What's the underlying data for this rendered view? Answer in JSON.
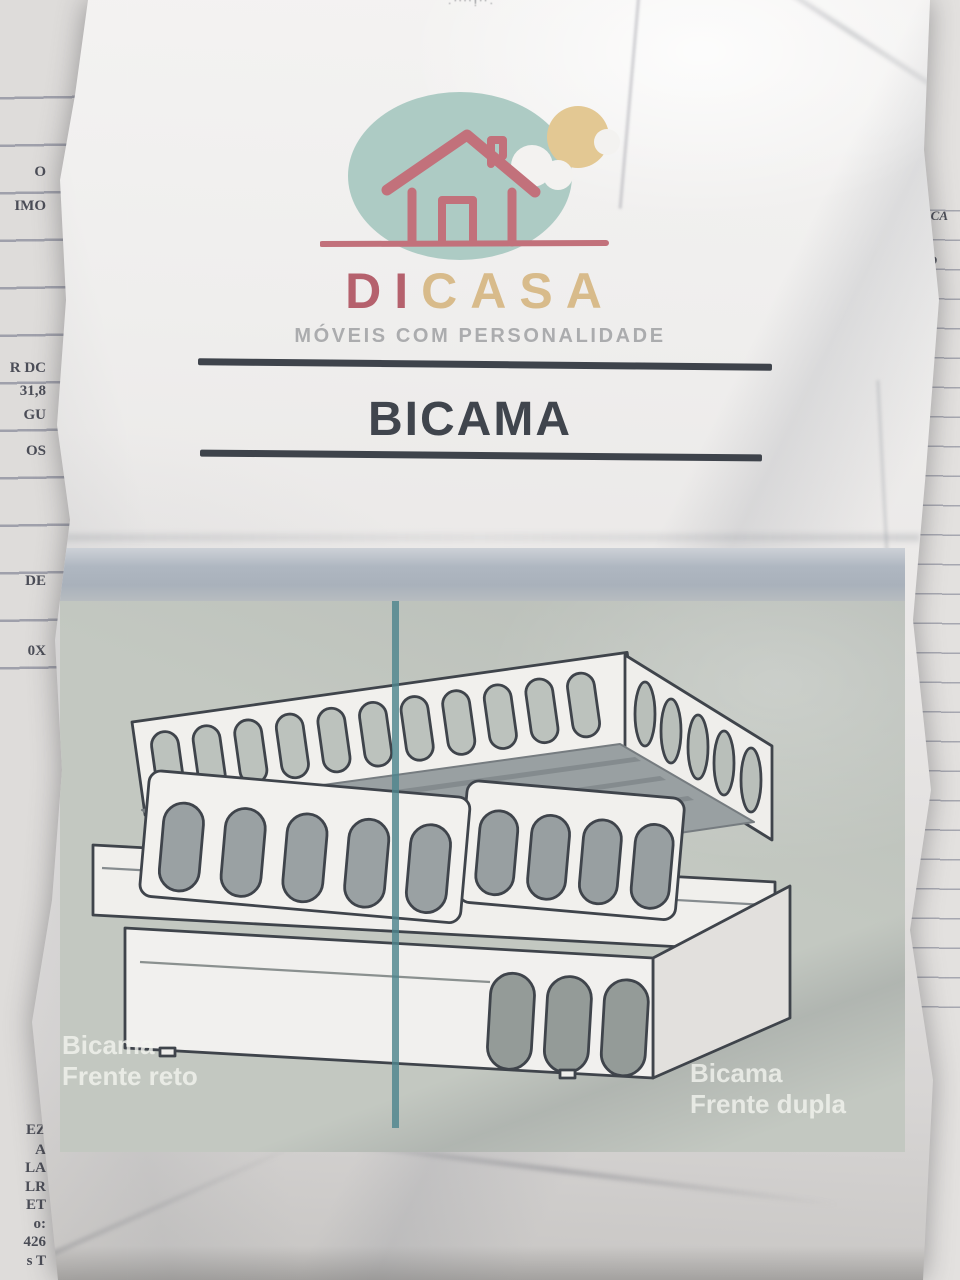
{
  "surroundings": {
    "top_edge_fragment": "·''''!''·",
    "left_page_fragments": [
      {
        "text": "O",
        "top": 164
      },
      {
        "text": "IMO",
        "top": 198
      },
      {
        "text": "R DC",
        "top": 360
      },
      {
        "text": "31,8",
        "top": 383
      },
      {
        "text": "GU",
        "top": 407
      },
      {
        "text": "OS",
        "top": 443
      },
      {
        "text": "DE",
        "top": 573
      },
      {
        "text": "0X",
        "top": 643
      },
      {
        "text": "EZ",
        "top": 1122
      },
      {
        "text": "A",
        "top": 1142
      },
      {
        "text": "LA",
        "top": 1160
      },
      {
        "text": "LR",
        "top": 1179
      },
      {
        "text": "ET",
        "top": 1197
      },
      {
        "text": "o:",
        "top": 1216
      },
      {
        "text": "426",
        "top": 1234
      },
      {
        "text": "s T",
        "top": 1253
      }
    ],
    "right_page_fragments": [
      {
        "text": "≡ CA",
        "top": 208
      },
      {
        "text": "0",
        "top": 232
      },
      {
        "text": "TO",
        "top": 253
      },
      {
        "text": "0,0",
        "top": 278
      }
    ]
  },
  "logo": {
    "brand_di": "DI",
    "brand_casa": "CASA",
    "tagline": "MÓVEIS COM PERSONALIDADE",
    "colors": {
      "circle": "#adcbc4",
      "sun": "#e3c893",
      "cloud": "#f3f2f0",
      "house_outline": "#c2717b",
      "di_text": "#b5616d",
      "casa_text": "#d8bb8b",
      "tagline_text": "#95979a"
    }
  },
  "title": {
    "text": "BICAMA",
    "color": "#40454d"
  },
  "illustration": {
    "divider_color": "#4e858d",
    "label_left_line1": "Bicama",
    "label_left_line2": "Frente reto",
    "label_right_line1": "Bicama",
    "label_right_line2": "Frente dupla"
  }
}
